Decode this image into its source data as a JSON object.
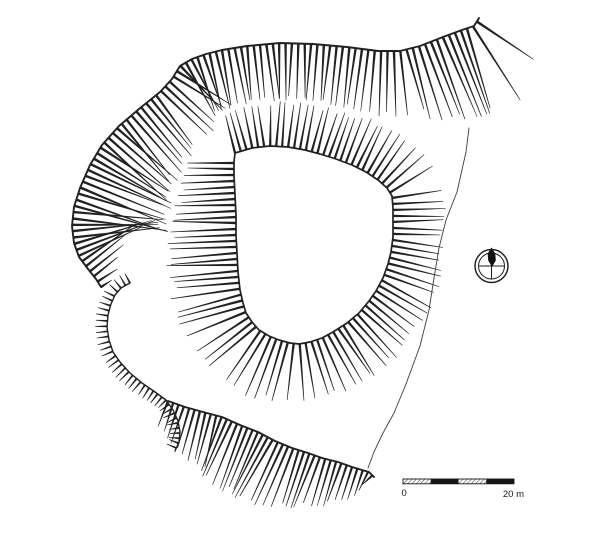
{
  "figure": {
    "kind": "archaeological-earthwork-hachure-plan",
    "background": "#ffffff",
    "ink": "#212121",
    "faint_line": "#3c3c3c",
    "width": 600,
    "height": 533
  },
  "scale_bar": {
    "label_start": "0",
    "label_end": "20 m",
    "x": 403,
    "y": 479,
    "width": 111,
    "height": 4.8,
    "segments": 4,
    "solid_color": "#161616"
  },
  "north_arrow": {
    "cx": 491.5,
    "cy": 266,
    "r_outer": 16.5,
    "r_inner": 13,
    "pointer_color": "#111111"
  },
  "plan_features": [
    {
      "name": "outer-scarp",
      "kind": "hachure-band",
      "closed": false,
      "side": 1,
      "spacing": 6.4,
      "head_w": 1.25,
      "tail_w": 0.3,
      "crest_width": 1.9,
      "points": [
        [
          101,
          287
        ],
        [
          96,
          279
        ],
        [
          88,
          269
        ],
        [
          79,
          257
        ],
        [
          74,
          243
        ],
        [
          72,
          226
        ],
        [
          74,
          207
        ],
        [
          80,
          188
        ],
        [
          90,
          165
        ],
        [
          102,
          145
        ],
        [
          119,
          126
        ],
        [
          139,
          109
        ],
        [
          160,
          92
        ],
        [
          172,
          79
        ],
        [
          180,
          66
        ],
        [
          192,
          59
        ],
        [
          206,
          54
        ],
        [
          222,
          50
        ],
        [
          247,
          46
        ],
        [
          280,
          43
        ],
        [
          313,
          44
        ],
        [
          347,
          47
        ],
        [
          378,
          51
        ],
        [
          400,
          51
        ],
        [
          420,
          46
        ],
        [
          443,
          37
        ],
        [
          462,
          30
        ],
        [
          474,
          26
        ],
        [
          479,
          18
        ]
      ],
      "length_profile": [
        [
          0,
          13
        ],
        [
          0.03,
          40
        ],
        [
          0.08,
          82
        ],
        [
          0.16,
          92
        ],
        [
          0.24,
          88
        ],
        [
          0.32,
          74
        ],
        [
          0.42,
          62
        ],
        [
          0.5,
          57
        ],
        [
          0.6,
          56
        ],
        [
          0.7,
          55
        ],
        [
          0.78,
          58
        ],
        [
          0.85,
          64
        ],
        [
          0.9,
          78
        ],
        [
          0.95,
          92
        ],
        [
          0.98,
          88
        ],
        [
          1,
          64
        ]
      ]
    },
    {
      "name": "inner-platform-scarp",
      "kind": "hachure-band",
      "closed": true,
      "side": -1,
      "spacing": 6.0,
      "head_w": 1.2,
      "tail_w": 0.3,
      "crest_width": 1.7,
      "points": [
        [
          235,
          153
        ],
        [
          252,
          148
        ],
        [
          270,
          146
        ],
        [
          288,
          147
        ],
        [
          305,
          150
        ],
        [
          320,
          154
        ],
        [
          336,
          159
        ],
        [
          352,
          165
        ],
        [
          366,
          172
        ],
        [
          378,
          180
        ],
        [
          387,
          188
        ],
        [
          392,
          196
        ],
        [
          393,
          208
        ],
        [
          393,
          222
        ],
        [
          393,
          237
        ],
        [
          391,
          252
        ],
        [
          388,
          264
        ],
        [
          383,
          278
        ],
        [
          376,
          291
        ],
        [
          369,
          301
        ],
        [
          359,
          313
        ],
        [
          347,
          323
        ],
        [
          333,
          332
        ],
        [
          322,
          338
        ],
        [
          310,
          342
        ],
        [
          299,
          344
        ],
        [
          290,
          343
        ],
        [
          279,
          340
        ],
        [
          269,
          336
        ],
        [
          259,
          330
        ],
        [
          252,
          322
        ],
        [
          246,
          313
        ],
        [
          243,
          303
        ],
        [
          240,
          290
        ],
        [
          238,
          272
        ],
        [
          237,
          253
        ],
        [
          236,
          235
        ],
        [
          236,
          215
        ],
        [
          235,
          195
        ],
        [
          234,
          175
        ],
        [
          234,
          162
        ]
      ],
      "length_profile": [
        [
          0,
          40
        ],
        [
          0.14,
          45
        ],
        [
          0.28,
          50
        ],
        [
          0.36,
          50
        ],
        [
          0.45,
          54
        ],
        [
          0.55,
          57
        ],
        [
          0.63,
          58
        ],
        [
          0.71,
          63
        ],
        [
          0.82,
          68
        ],
        [
          0.9,
          62
        ],
        [
          0.96,
          50
        ],
        [
          1,
          42
        ]
      ]
    },
    {
      "name": "south-scarp",
      "kind": "hachure-band",
      "closed": false,
      "side": 1,
      "spacing": 5.6,
      "head_w": 1.2,
      "tail_w": 0.3,
      "crest_width": 1.9,
      "points": [
        [
          168,
          401
        ],
        [
          185,
          407
        ],
        [
          203,
          412
        ],
        [
          222,
          417
        ],
        [
          240,
          425
        ],
        [
          258,
          432
        ],
        [
          275,
          441
        ],
        [
          292,
          448
        ],
        [
          308,
          453
        ],
        [
          322,
          458
        ],
        [
          338,
          462
        ],
        [
          352,
          467
        ],
        [
          362,
          470
        ],
        [
          369,
          472
        ],
        [
          374,
          477
        ]
      ],
      "length_profile": [
        [
          0,
          26
        ],
        [
          0.12,
          45
        ],
        [
          0.3,
          62
        ],
        [
          0.5,
          68
        ],
        [
          0.68,
          55
        ],
        [
          0.82,
          44
        ],
        [
          0.92,
          30
        ],
        [
          1,
          12
        ]
      ]
    },
    {
      "name": "hollow-way-scarp",
      "kind": "hachure-band",
      "closed": false,
      "side": 1,
      "spacing": 5.2,
      "head_w": 1.0,
      "tail_w": 0.3,
      "crest_width": 1.4,
      "points": [
        [
          130,
          283
        ],
        [
          121,
          288
        ],
        [
          115,
          295
        ],
        [
          111,
          304
        ],
        [
          108,
          315
        ],
        [
          107,
          327
        ],
        [
          109,
          340
        ],
        [
          113,
          352
        ],
        [
          120,
          362
        ],
        [
          130,
          373
        ],
        [
          142,
          383
        ],
        [
          155,
          392
        ],
        [
          166,
          400
        ],
        [
          173,
          410
        ],
        [
          178,
          421
        ],
        [
          180,
          432
        ],
        [
          179,
          442
        ],
        [
          175,
          451
        ]
      ],
      "length_profile": [
        [
          0,
          11
        ],
        [
          0.5,
          13
        ],
        [
          1,
          10
        ]
      ]
    },
    {
      "name": "east-toe-line",
      "kind": "line",
      "width": 0.9,
      "points": [
        [
          469,
          128
        ],
        [
          466,
          152
        ],
        [
          457,
          192
        ],
        [
          446,
          220
        ],
        [
          439,
          248
        ],
        [
          434,
          278
        ],
        [
          429,
          310
        ],
        [
          420,
          346
        ],
        [
          406,
          384
        ],
        [
          394,
          413
        ],
        [
          383,
          433
        ],
        [
          374,
          452
        ],
        [
          368,
          468
        ]
      ]
    }
  ]
}
